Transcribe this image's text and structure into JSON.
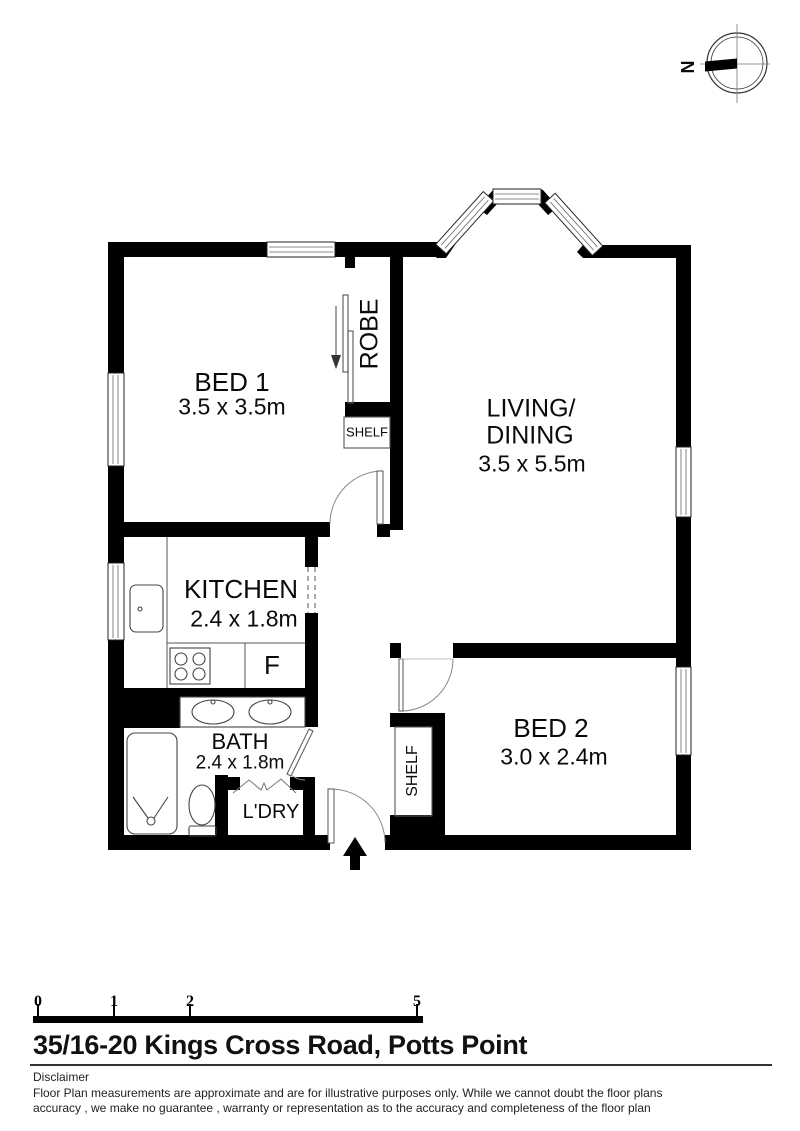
{
  "compass": {
    "label": "N"
  },
  "rooms": {
    "bed1": {
      "name": "BED 1",
      "dims": "3.5 x 3.5m"
    },
    "living": {
      "name_line1": "LIVING/",
      "name_line2": "DINING",
      "dims": "3.5 x 5.5m"
    },
    "kitchen": {
      "name": "KITCHEN",
      "dims": "2.4 x 1.8m"
    },
    "bath": {
      "name": "BATH",
      "dims": "2.4 x 1.8m"
    },
    "laundry": {
      "name": "L'DRY"
    },
    "bed2": {
      "name": "BED 2",
      "dims": "3.0 x 2.4m"
    },
    "robe": {
      "name": "ROBE"
    },
    "shelf_bed1": {
      "name": "SHELF"
    },
    "shelf_bed2": {
      "name": "SHELF"
    },
    "fridge": {
      "label": "F"
    }
  },
  "scale_bar": {
    "ticks": [
      "0",
      "1",
      "2",
      "5"
    ]
  },
  "address": "35/16-20 Kings Cross Road, Potts Point",
  "disclaimer": {
    "title": "Disclaimer",
    "line1": "Floor Plan measurements are approximate and are for illustrative purposes only. While we cannot doubt the floor plans",
    "line2": "accuracy , we make no guarantee , warranty or representation as to the accuracy and completeness of the floor plan"
  }
}
